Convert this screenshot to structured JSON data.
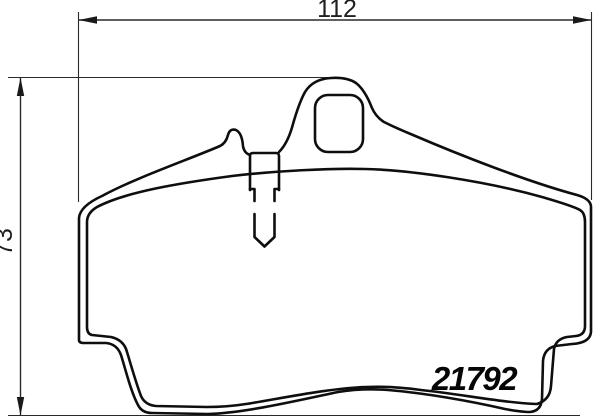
{
  "drawing": {
    "type": "technical-drawing",
    "subject": "disc-brake-pad-outline",
    "part_number": "21792",
    "dim_width": "112",
    "dim_height": "73",
    "colors": {
      "outline": "#0e0e0e",
      "dimension_lines": "#2a2a2a",
      "background": "#ffffff"
    }
  }
}
